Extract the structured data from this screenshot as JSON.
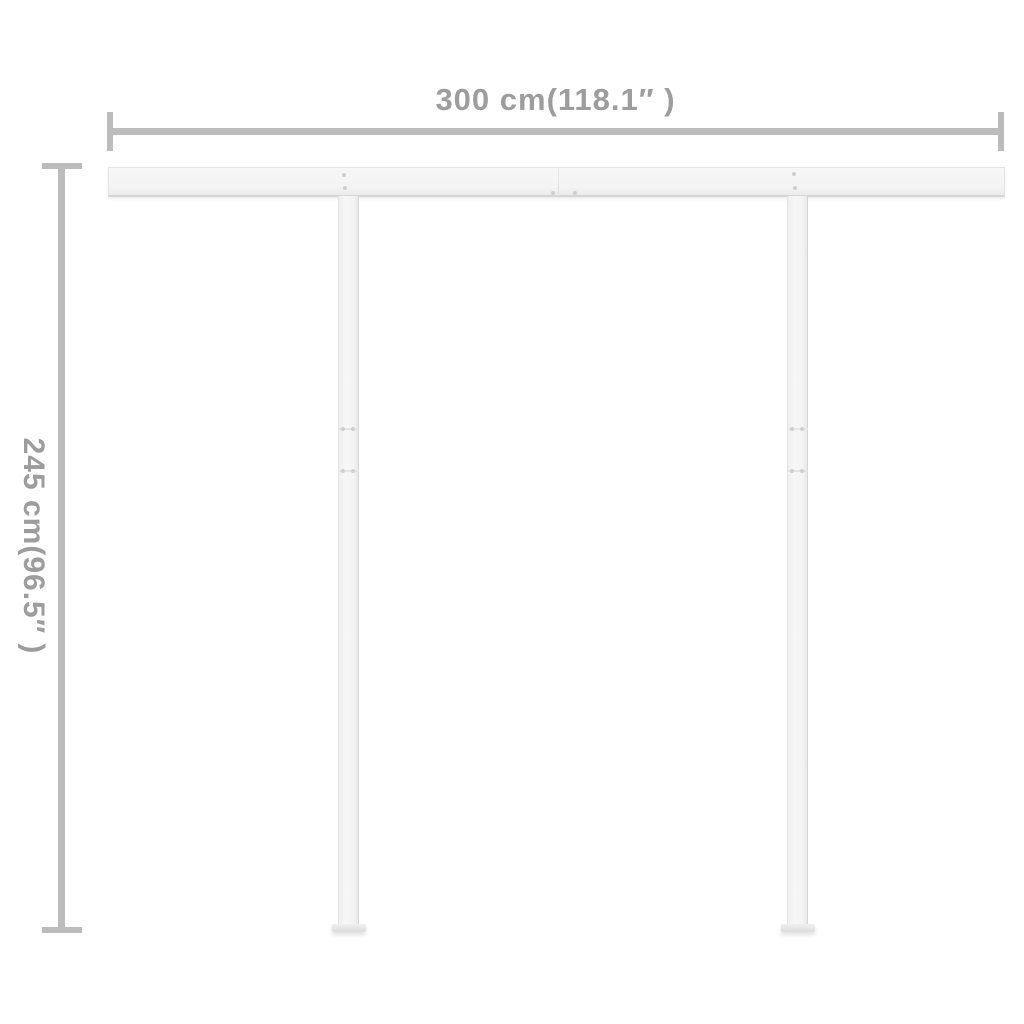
{
  "diagram": {
    "kind": "product-dimension-diagram",
    "width_dimension": {
      "label": "300 cm(118.1″ )",
      "value_cm": 300,
      "value_inches": 118.1
    },
    "height_dimension": {
      "label": "245 cm(96.5″ )",
      "value_cm": 245,
      "value_inches": 96.5
    },
    "colors": {
      "background": "#ffffff",
      "dimension_line": "#bcbcbc",
      "dimension_text": "#9d9d9d",
      "frame_fill": "#f4f4f4",
      "frame_edge": "#e4e4e4",
      "frame_shadow": "#d6d6d6",
      "screw": "#cfcfcf"
    }
  }
}
